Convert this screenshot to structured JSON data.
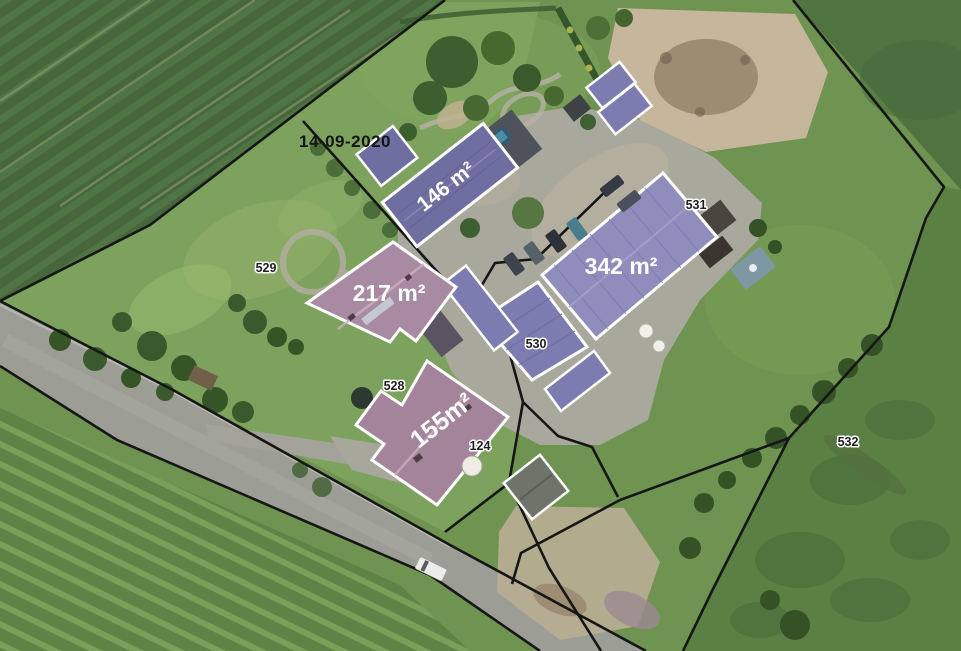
{
  "map": {
    "date_label": "14-09-2020",
    "area_labels": [
      {
        "building": "north-barn",
        "text": "146 m²"
      },
      {
        "building": "main-barn",
        "text": "342 m²"
      },
      {
        "building": "west-house",
        "text": "217 m²"
      },
      {
        "building": "south-house",
        "text": "155m²"
      }
    ],
    "parcel_labels": [
      "529",
      "530",
      "531",
      "532",
      "528",
      "124"
    ],
    "colors": {
      "building_outline": "#ffffff",
      "highlight_purple_dark": "#6f6ea0",
      "highlight_purple": "#8f8dbb",
      "highlight_purple_mid": "#7d7cb0",
      "roof_pink": "#a88ba2",
      "roof_pink_dark": "#a3849a",
      "shed_grey": "#6e746a",
      "parcel_line": "#161616",
      "area_label": "#ffffff",
      "parcel_label": "#1f1f1f",
      "date_label": "#151515"
    }
  }
}
